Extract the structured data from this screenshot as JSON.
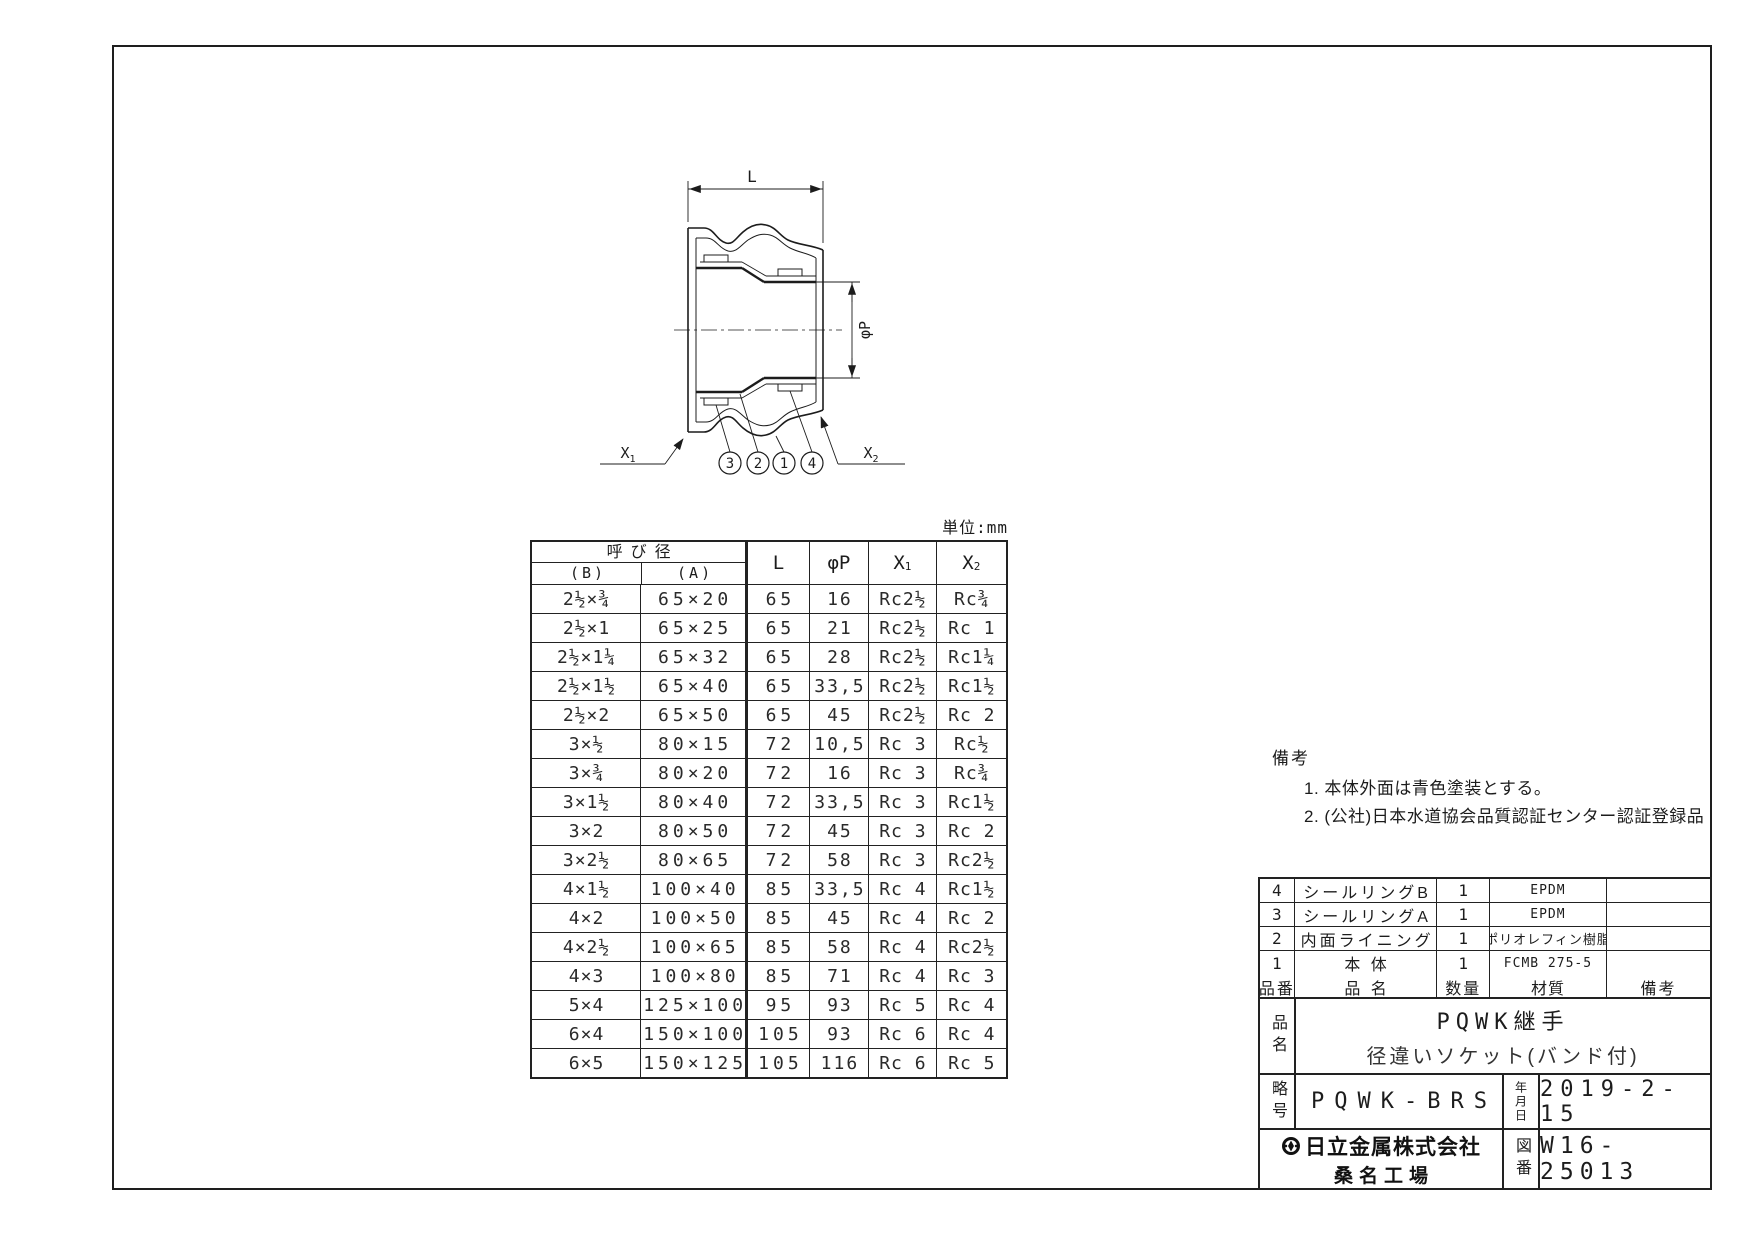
{
  "page": {
    "unit_note": "単位:mm"
  },
  "drawing": {
    "dim_l": "L",
    "dim_phi": "φP",
    "x_label": "X",
    "x1_sub": "1",
    "x2_sub": "2",
    "callouts": [
      "3",
      "2",
      "1",
      "4"
    ]
  },
  "dim_table": {
    "nominal_header": "呼び径",
    "col_b": "(B)",
    "col_a": "(A)",
    "col_l": "L",
    "col_phi": "φP",
    "col_x": "X",
    "col_x1_sub": "1",
    "col_x2_sub": "2",
    "rows": [
      [
        "2½×¾",
        "65×20",
        "65",
        "16",
        "Rc2½",
        "Rc¾"
      ],
      [
        "2½×1",
        "65×25",
        "65",
        "21",
        "Rc2½",
        "Rc 1"
      ],
      [
        "2½×1¼",
        "65×32",
        "65",
        "28",
        "Rc2½",
        "Rc1¼"
      ],
      [
        "2½×1½",
        "65×40",
        "65",
        "33,5",
        "Rc2½",
        "Rc1½"
      ],
      [
        "2½×2",
        "65×50",
        "65",
        "45",
        "Rc2½",
        "Rc 2"
      ],
      [
        "3×½",
        "80×15",
        "72",
        "10,5",
        "Rc 3",
        "Rc½"
      ],
      [
        "3×¾",
        "80×20",
        "72",
        "16",
        "Rc 3",
        "Rc¾"
      ],
      [
        "3×1½",
        "80×40",
        "72",
        "33,5",
        "Rc 3",
        "Rc1½"
      ],
      [
        "3×2",
        "80×50",
        "72",
        "45",
        "Rc 3",
        "Rc 2"
      ],
      [
        "3×2½",
        "80×65",
        "72",
        "58",
        "Rc 3",
        "Rc2½"
      ],
      [
        "4×1½",
        "100×40",
        "85",
        "33,5",
        "Rc 4",
        "Rc1½"
      ],
      [
        "4×2",
        "100×50",
        "85",
        "45",
        "Rc 4",
        "Rc 2"
      ],
      [
        "4×2½",
        "100×65",
        "85",
        "58",
        "Rc 4",
        "Rc2½"
      ],
      [
        "4×3",
        "100×80",
        "85",
        "71",
        "Rc 4",
        "Rc 3"
      ],
      [
        "5×4",
        "125×100",
        "95",
        "93",
        "Rc 5",
        "Rc 4"
      ],
      [
        "6×4",
        "150×100",
        "105",
        "93",
        "Rc 6",
        "Rc 4"
      ],
      [
        "6×5",
        "150×125",
        "105",
        "116",
        "Rc 6",
        "Rc 5"
      ]
    ]
  },
  "notes": {
    "title": "備考",
    "item1": "1. 本体外面は青色塗装とする。",
    "item2": "2. (公社)日本水道協会品質認証センター認証登録品"
  },
  "parts_table": {
    "rows": [
      [
        "4",
        "シールリングB",
        "1",
        "EPDM",
        ""
      ],
      [
        "3",
        "シールリングA",
        "1",
        "EPDM",
        ""
      ],
      [
        "2",
        "内面ライニング",
        "1",
        "ポリオレフィン樹脂",
        ""
      ],
      [
        "1",
        "本 体",
        "1",
        "FCMB 275-5",
        ""
      ]
    ],
    "header": {
      "no": "品番",
      "name": "品 名",
      "qty": "数量",
      "material": "材質",
      "remarks": "備考"
    }
  },
  "title_block": {
    "name_label": "品名",
    "product_line1": "PQWK継手",
    "product_line2": "径違いソケット(バンド付)",
    "code_label": "略号",
    "code": "PQWK-BRS",
    "date_label": "年月日",
    "date": "2019-2-15",
    "company": "日立金属株式会社",
    "factory": "桑名工場",
    "drawing_no_label": "図番",
    "drawing_no": "W16-25013"
  }
}
